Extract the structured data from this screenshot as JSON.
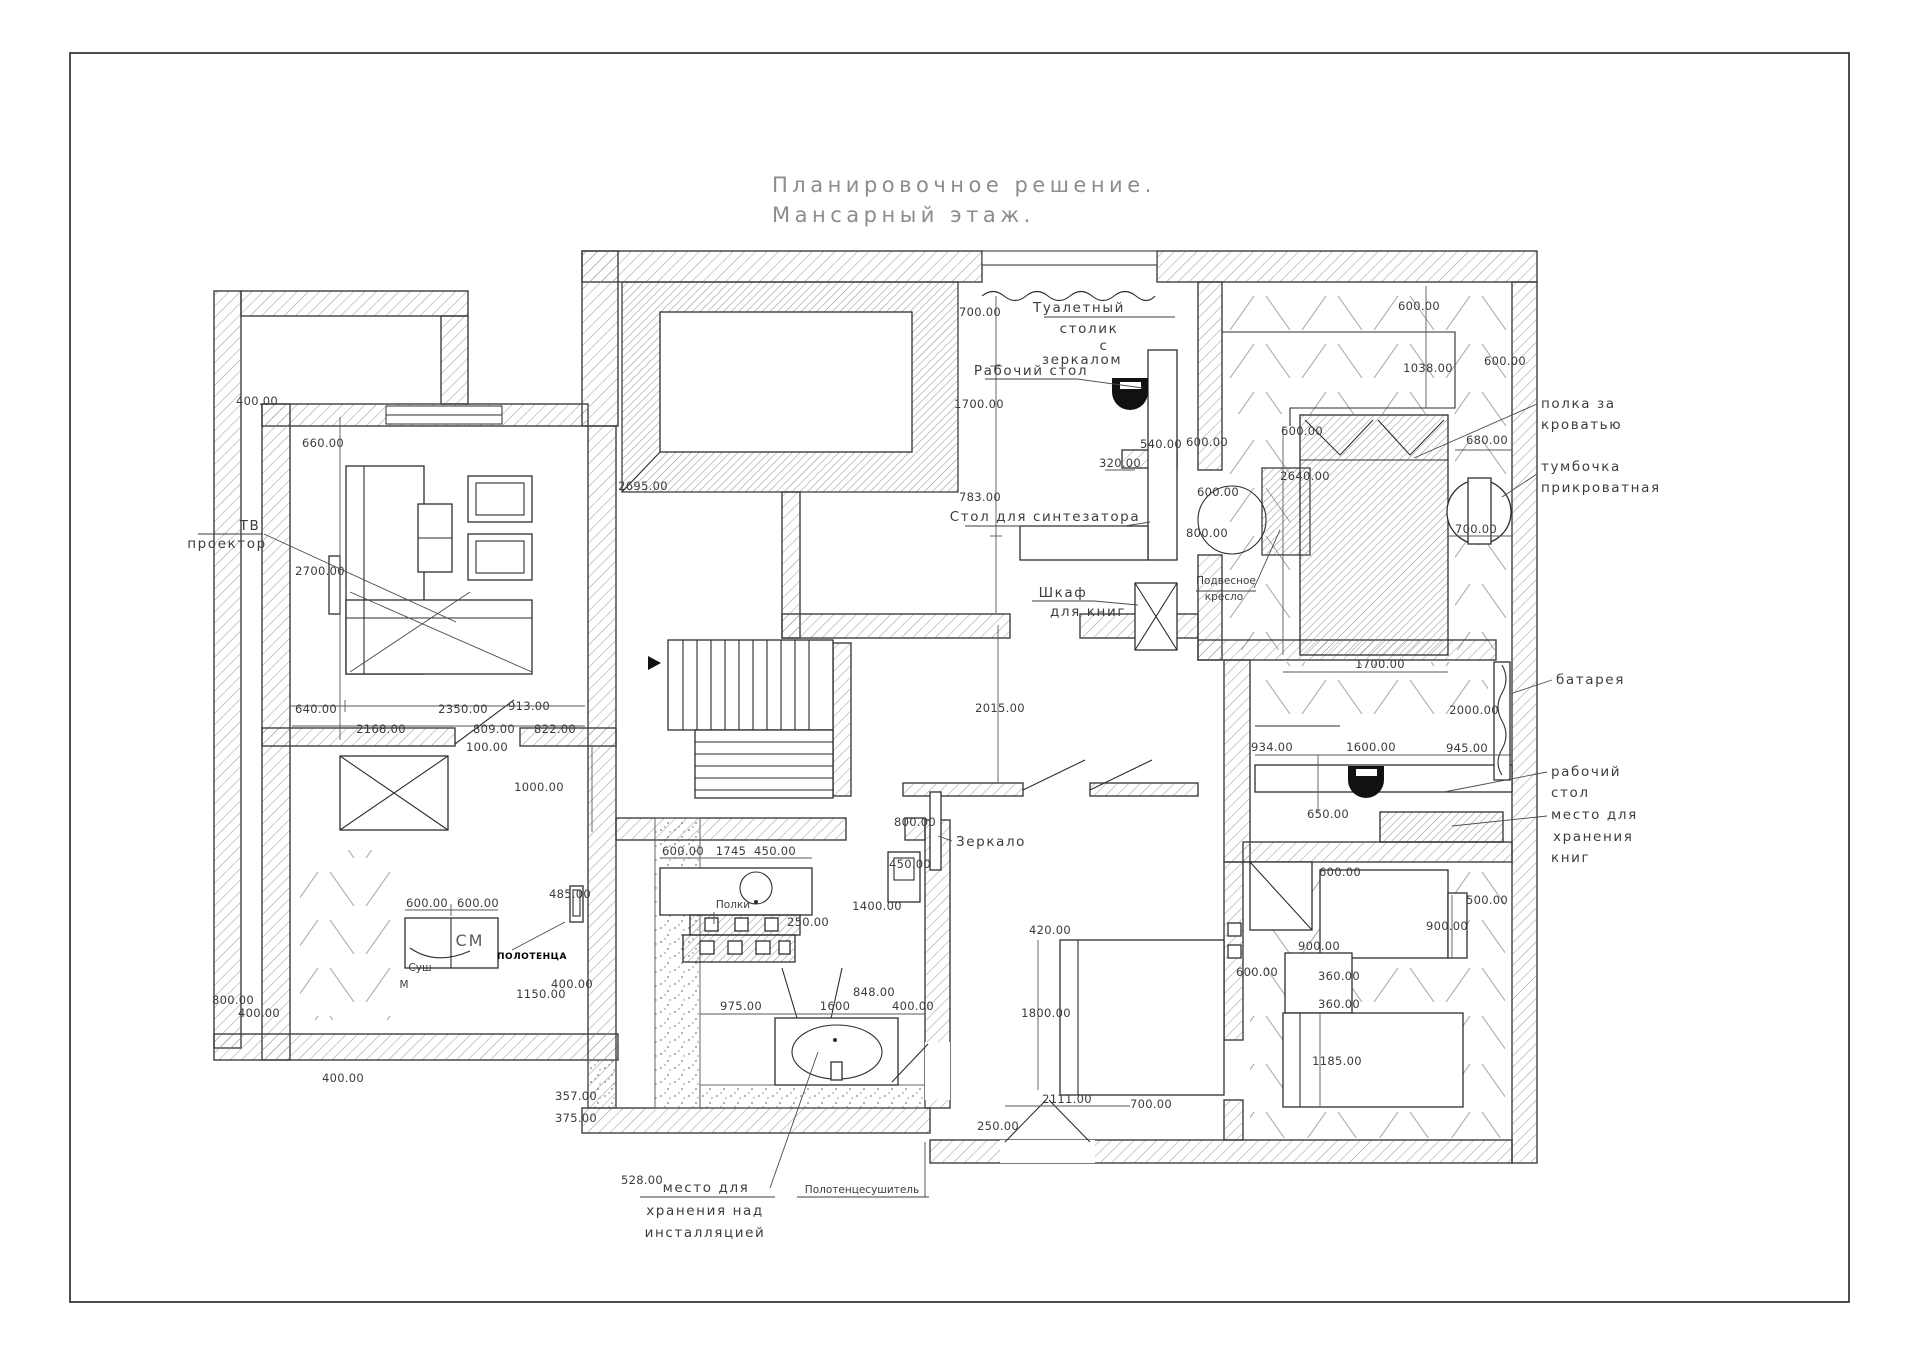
{
  "title": {
    "line1": "Планировочное решение.",
    "line2": "Мансарный этаж."
  },
  "labels": {
    "tv_1": "ТВ",
    "tv_2": "проектор",
    "dressing_1": "Туалетный",
    "dressing_2": "столик",
    "dressing_3": "с",
    "dressing_4": "зеркалом",
    "worktable_top": "Рабочий стол",
    "synth": "Стол для синтезатора",
    "bookcase_1": "Шкаф",
    "bookcase_2": "для книг",
    "hang_1": "Подвесное",
    "hang_2": "кресло",
    "shelf_bed_1": "полка за",
    "shelf_bed_2": "кроватью",
    "nightstand_1": "тумбочка",
    "nightstand_2": "прикроватная",
    "battery": "батарея",
    "desk_r_1": "рабочий",
    "desk_r_2": "стол",
    "books_r_1": "место для",
    "books_r_2": "хранения",
    "books_r_3": "книг",
    "mirror": "Зеркало",
    "shelves": "Полки",
    "washer": "СМ",
    "dryer_1": "Суш",
    "dryer_2": "М",
    "towels": "ПОЛОТЕНЦА",
    "storage_1": "место для",
    "storage_2": "хранения над",
    "storage_3": "инсталляцией",
    "towel_dryer": "Полотенцесушитель"
  },
  "dims": [
    "400.00",
    "660.00",
    "2700.00",
    "640.00",
    "2350.00",
    "913.00",
    "2168.00",
    "809.00",
    "100.00",
    "822.00",
    "1000.00",
    "600.00",
    "600.00",
    "485.00",
    "400.00",
    "1150.00",
    "800.00",
    "400.00",
    "400.00",
    "600.00",
    "1745",
    "450.00",
    "250.00",
    "975.00",
    "1600",
    "848.00",
    "400.00",
    "357.00",
    "375.00",
    "528.00",
    "800.00",
    "450.00",
    "1400.00",
    "2015.00",
    "250.00",
    "2111.00",
    "700.00",
    "700.00",
    "1700.00",
    "783.00",
    "320.00",
    "540.00",
    "600.00",
    "600.00",
    "800.00",
    "600.00",
    "1038.00",
    "600.00",
    "680.00",
    "2640.00",
    "700.00",
    "600.00",
    "1700.00",
    "2000.00",
    "934.00",
    "1600.00",
    "945.00",
    "650.00",
    "600.00",
    "500.00",
    "900.00",
    "900.00",
    "360.00",
    "360.00",
    "600.00",
    "1185.00",
    "420.00",
    "1800.00",
    "2695.00"
  ]
}
